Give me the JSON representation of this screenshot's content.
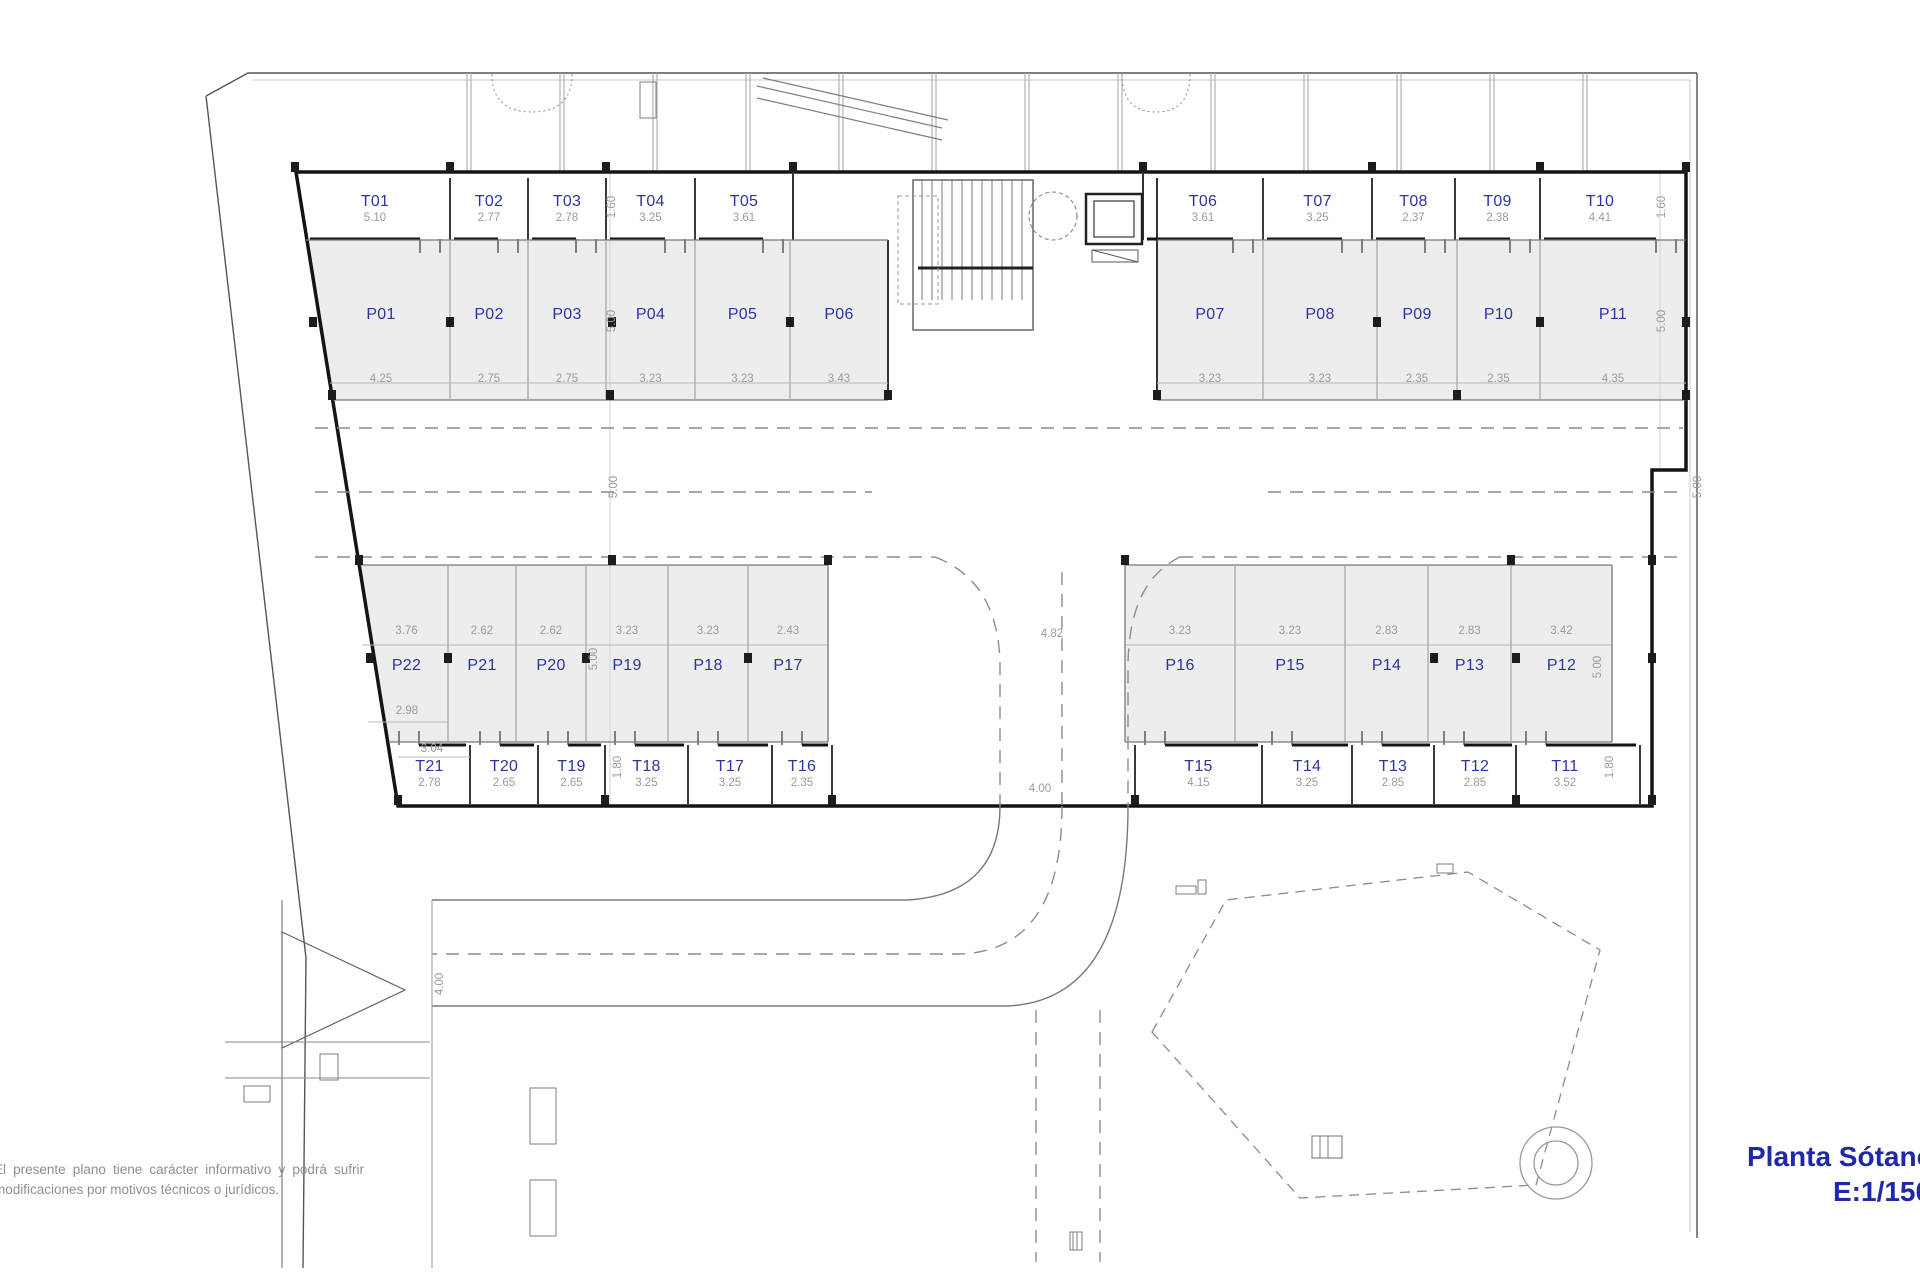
{
  "title": {
    "line1": "Planta Sótano",
    "line2": "E:1/150"
  },
  "disclaimer": {
    "line1": "El presente plano tiene carácter informativo y podrá sufrir",
    "line2": "modificaciones por motivos técnicos o jurídicos."
  },
  "plan": {
    "storage_top": [
      {
        "id": "T01",
        "dim": "5.10"
      },
      {
        "id": "T02",
        "dim": "2.77"
      },
      {
        "id": "T03",
        "dim": "2.78"
      },
      {
        "id": "T04",
        "dim": "3.25"
      },
      {
        "id": "T05",
        "dim": "3.61"
      },
      {
        "id": "T06",
        "dim": "3.61"
      },
      {
        "id": "T07",
        "dim": "3.25"
      },
      {
        "id": "T08",
        "dim": "2.37"
      },
      {
        "id": "T09",
        "dim": "2.38"
      },
      {
        "id": "T10",
        "dim": "4.41"
      }
    ],
    "parking_top": [
      {
        "id": "P01",
        "dim": "4.25"
      },
      {
        "id": "P02",
        "dim": "2.75"
      },
      {
        "id": "P03",
        "dim": "2.75"
      },
      {
        "id": "P04",
        "dim": "3.23"
      },
      {
        "id": "P05",
        "dim": "3.23"
      },
      {
        "id": "P06",
        "dim": "3.43"
      },
      {
        "id": "P07",
        "dim": "3.23"
      },
      {
        "id": "P08",
        "dim": "3.23"
      },
      {
        "id": "P09",
        "dim": "2.35"
      },
      {
        "id": "P10",
        "dim": "2.35"
      },
      {
        "id": "P11",
        "dim": "4.35"
      }
    ],
    "parking_bottom": [
      {
        "id": "P22",
        "dim": "3.76"
      },
      {
        "id": "P21",
        "dim": "2.62"
      },
      {
        "id": "P20",
        "dim": "2.62"
      },
      {
        "id": "P19",
        "dim": "3.23"
      },
      {
        "id": "P18",
        "dim": "3.23"
      },
      {
        "id": "P17",
        "dim": "2.43"
      },
      {
        "id": "P16",
        "dim": "3.23"
      },
      {
        "id": "P15",
        "dim": "3.23"
      },
      {
        "id": "P14",
        "dim": "2.83"
      },
      {
        "id": "P13",
        "dim": "2.83"
      },
      {
        "id": "P12",
        "dim": "3.42"
      }
    ],
    "storage_bottom": [
      {
        "id": "T21",
        "dim": "2.78"
      },
      {
        "id": "T20",
        "dim": "2.65"
      },
      {
        "id": "T19",
        "dim": "2.65"
      },
      {
        "id": "T18",
        "dim": "3.25"
      },
      {
        "id": "T17",
        "dim": "3.25"
      },
      {
        "id": "T16",
        "dim": "2.35"
      },
      {
        "id": "T15",
        "dim": "4.15"
      },
      {
        "id": "T14",
        "dim": "3.25"
      },
      {
        "id": "T13",
        "dim": "2.85"
      },
      {
        "id": "T12",
        "dim": "2.85"
      },
      {
        "id": "T11",
        "dim": "3.52"
      }
    ],
    "dims": {
      "storage_top_depth": "1.60",
      "parking_depth": "5.00",
      "aisle_width": "5.00",
      "storage_bottom_depth": "1.80",
      "ramp_width_parking": "4.82",
      "ramp_width_storage": "4.00",
      "access_width": "4.00",
      "p22_inner": "2.98",
      "p22_outer": "3.04"
    }
  }
}
